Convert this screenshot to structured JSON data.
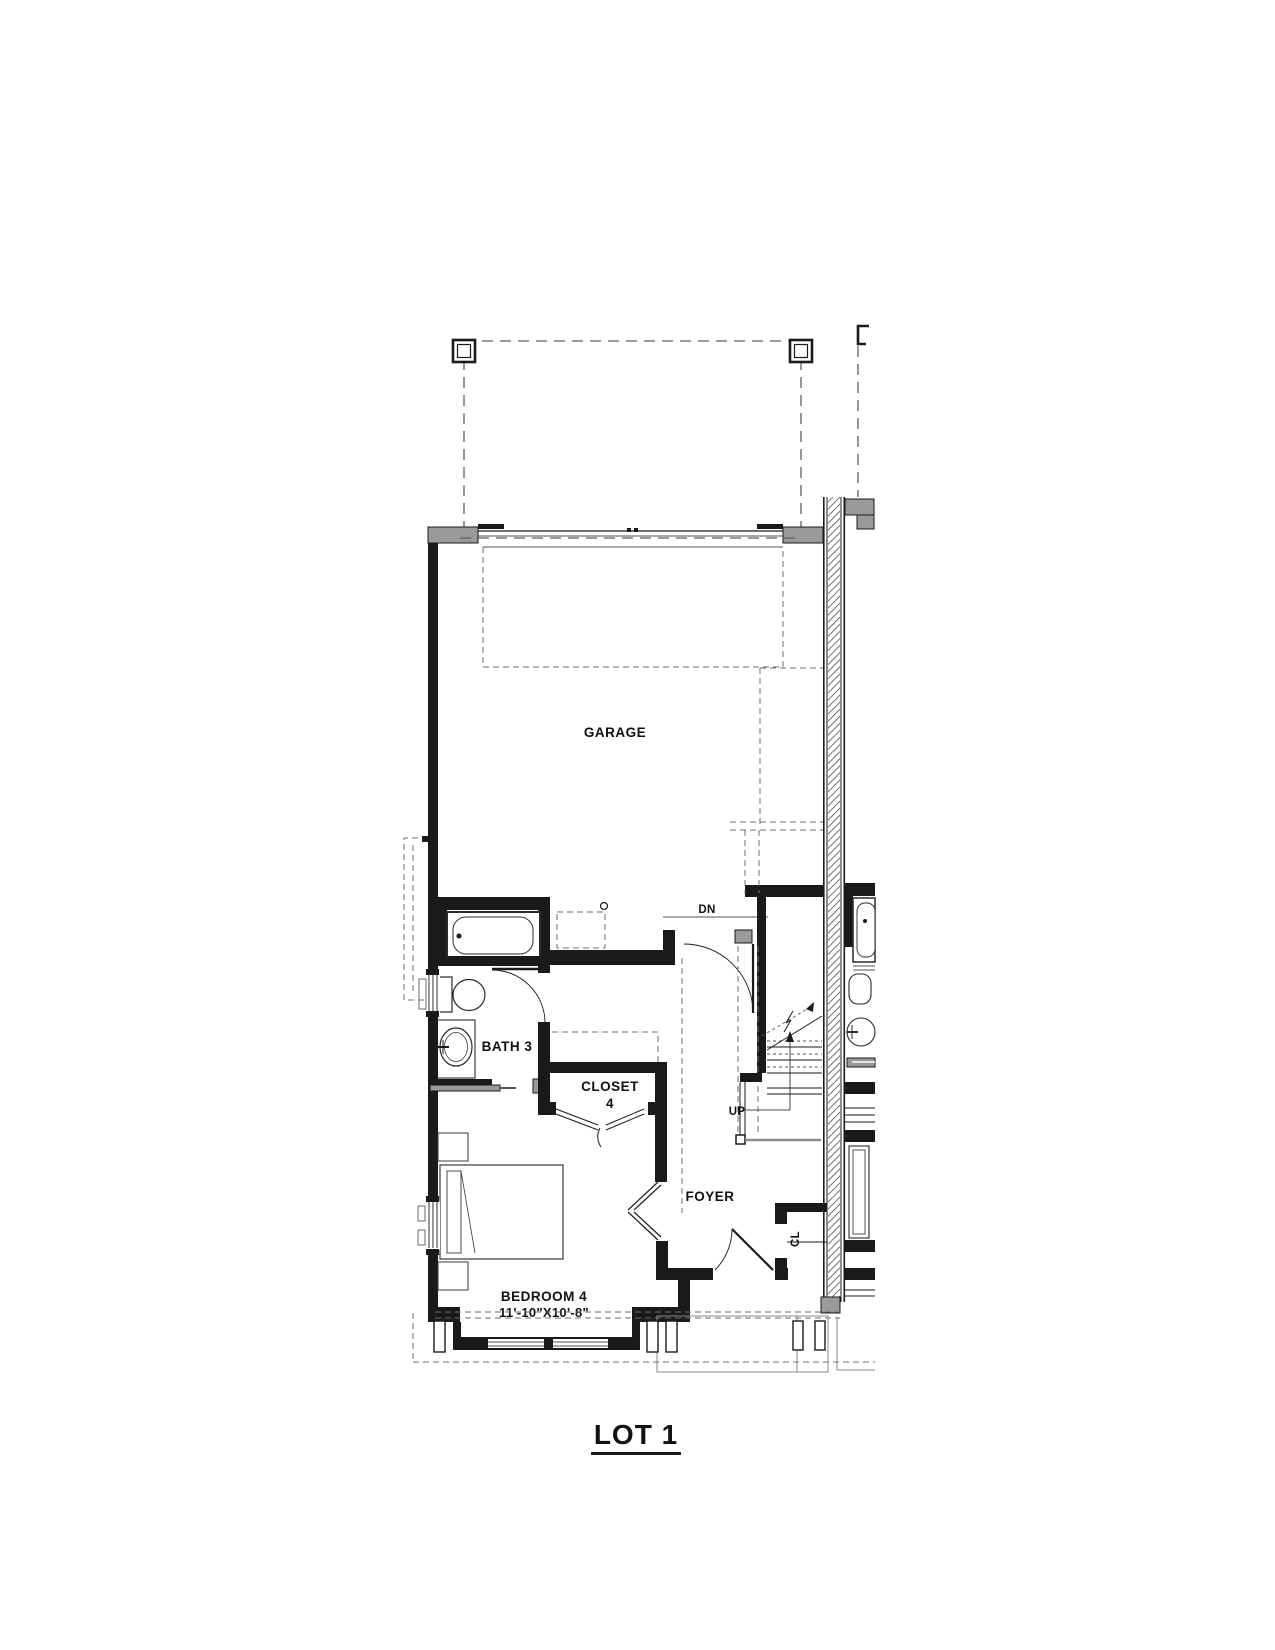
{
  "sheet": {
    "title": "LOT 1"
  },
  "rooms": {
    "garage": {
      "label": "GARAGE"
    },
    "bath3": {
      "label": "BATH 3"
    },
    "closet4": {
      "line1": "CLOSET",
      "line2": "4"
    },
    "foyer": {
      "label": "FOYER"
    },
    "bedroom4": {
      "label": "BEDROOM 4",
      "dims": "11'-10\"X10'-8\""
    },
    "coat_closet": {
      "label": "CL"
    }
  },
  "stairs": {
    "down": "DN",
    "up": "UP"
  },
  "colors": {
    "line": "#1a1a1a",
    "wall_gray": "#9a9a9a",
    "dash_gray": "#6e6e6e",
    "background": "#ffffff"
  }
}
